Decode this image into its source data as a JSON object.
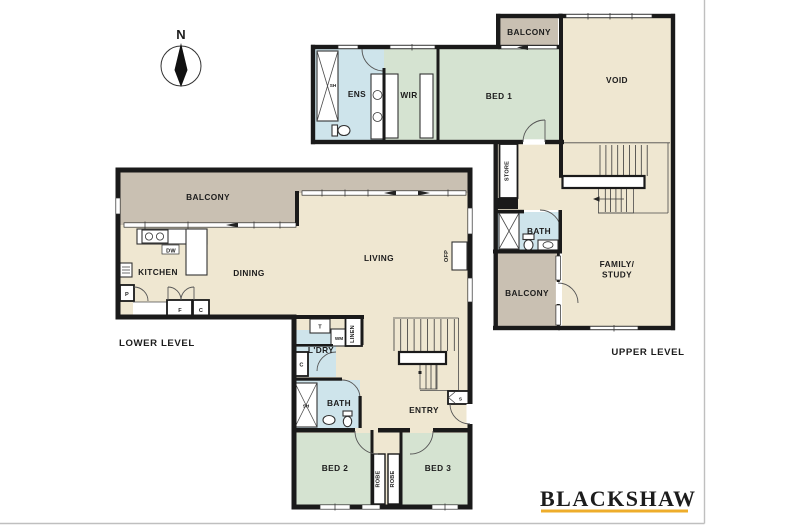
{
  "palette": {
    "floor": "#EFE7D1",
    "bedroom": "#D5E3D1",
    "wet": "#CEE4EB",
    "balcony": "#C9C0B2",
    "wall": "#1A1A1A",
    "logo_navy": "#273060",
    "logo_gold": "#EEAD2B"
  },
  "compass": {
    "north": "N"
  },
  "lower_level": {
    "caption": "LOWER LEVEL",
    "labels": {
      "balcony": "BALCONY",
      "kitchen": "KITCHEN",
      "dining": "DINING",
      "living": "LIVING",
      "laundry": "L'DRY",
      "bath": "BATH",
      "entry": "ENTRY",
      "bed2": "BED 2",
      "bed3": "BED 3",
      "robe1": "ROBE",
      "robe2": "ROBE",
      "linen": "LINEN",
      "wm": "WM",
      "trough": "T",
      "cupboard_kitchen": "C",
      "cupboard_laundry": "C",
      "fridge": "F",
      "pantry": "P",
      "dishwasher": "DW",
      "shower": "SH",
      "fireplace": "OFP",
      "store_s": "S"
    }
  },
  "upper_level": {
    "caption": "UPPER LEVEL",
    "labels": {
      "balcony_top": "BALCONY",
      "balcony_mid": "BALCONY",
      "ens": "ENS",
      "wir": "WIR",
      "bed1": "BED 1",
      "void": "VOID",
      "store": "STORE",
      "bath": "BATH",
      "family_line1": "FAMILY/",
      "family_line2": "STUDY",
      "shower": "SH"
    }
  },
  "logo": {
    "brand": "BLACKSHAW"
  }
}
